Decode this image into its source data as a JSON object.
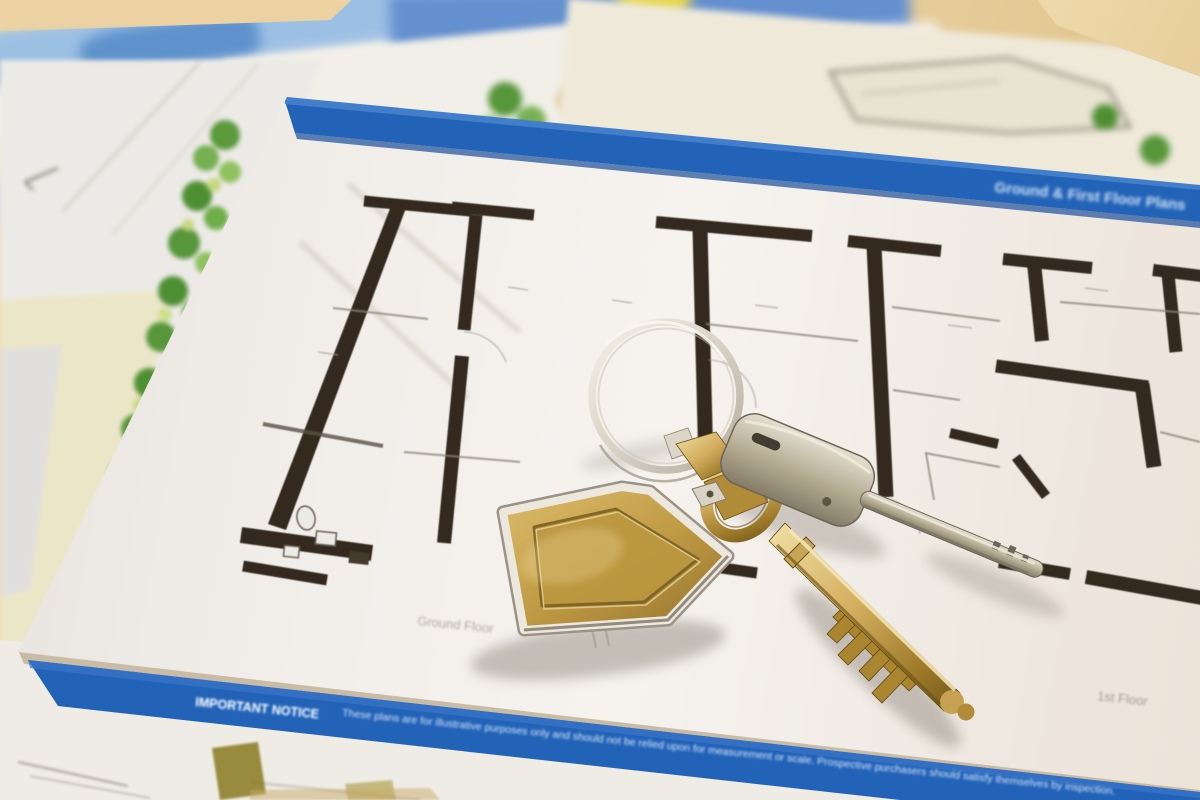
{
  "scene": {
    "type": "photograph",
    "subject": "A pair of house keys on a silver keyring with a brass house-shaped fob, lying on architectural floor-plan documents",
    "background": "stacked property brochures, a landscaped site plan and duplicate floor-plan sheets on a tan desk"
  },
  "floor_plan_sheet": {
    "header_band_text": "Ground & First Floor Plans",
    "ground_floor_label": "Ground Floor",
    "first_floor_label": "1st Floor",
    "notice_heading": "IMPORTANT NOTICE",
    "notice_body": "These plans are for illustrative purposes only and should not be relied upon for measurement or scale. Prospective purchasers should satisfy themselves by inspection.",
    "colors": {
      "band_blue": "#2263b8",
      "wall_ink": "#33291e",
      "paper_white": "#f2efeb",
      "thin_line": "#8d8478"
    }
  },
  "site_plan": {
    "tree_green": "#4f8f33",
    "lawn_yellow_green": "#c6d87e",
    "paper_cream": "#efe9da"
  },
  "objects": {
    "keyring": {
      "metal": "silver",
      "color": "#d9d5ca"
    },
    "house_fob": {
      "shape": "house",
      "face_color": "#c09a44",
      "rim_color": "#ece8de"
    },
    "brass_key": {
      "type": "mortice key",
      "color": "#c29b4a"
    },
    "silver_key": {
      "type": "cylinder key",
      "color": "#b2a98f"
    }
  },
  "desk": {
    "color": "#e9d2a2"
  }
}
